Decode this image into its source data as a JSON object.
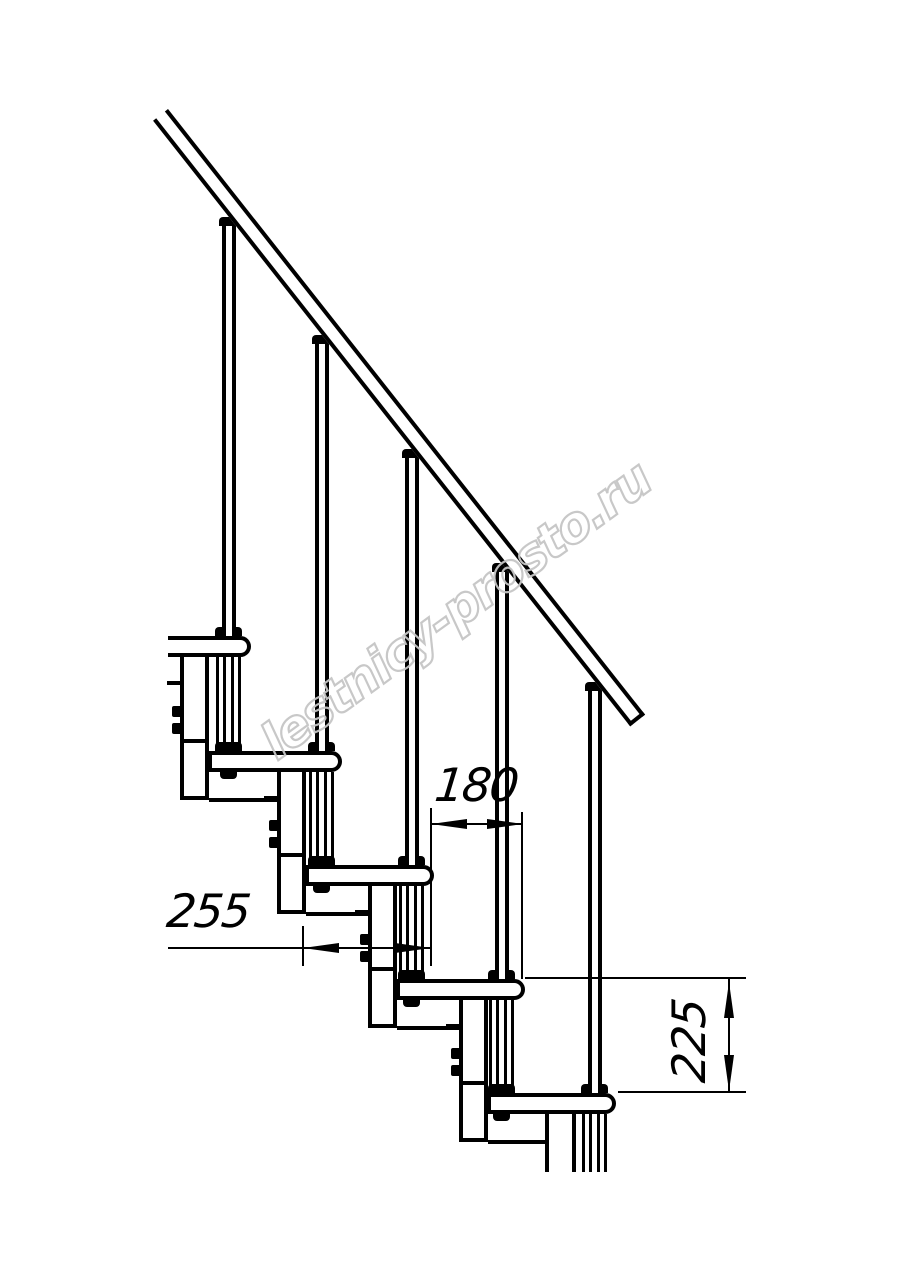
{
  "watermark": {
    "text": "lestnicy-prosto.ru",
    "color": "#c6c6c6"
  },
  "dimensions": {
    "step_run": {
      "label": "180"
    },
    "tread_depth": {
      "label": "255"
    },
    "step_rise": {
      "label": "225"
    }
  },
  "drawing": {
    "type": "technical-drawing",
    "subject": "modular staircase side view: inclined handrail, five balusters, five treads with support columns, dimensioned 180 / 255 / 225",
    "colors": {
      "line": "#000000",
      "background": "#ffffff"
    },
    "treads": {
      "tops": [
        636,
        751,
        865,
        979,
        1093
      ],
      "lefts": [
        168,
        208,
        305,
        396,
        487
      ],
      "rights": [
        251,
        342,
        434,
        525,
        616
      ],
      "height": 21
    },
    "rods": {
      "centers": [
        228.5,
        321.5,
        411.5,
        501.5,
        594.5
      ],
      "collar_tops": [
        217,
        335,
        449,
        563,
        682
      ]
    },
    "columns": {
      "lefts": [
        180,
        277,
        368,
        459,
        545
      ],
      "width": 29
    },
    "rail": {
      "x": 168,
      "y": 109,
      "length": 771,
      "thickness": 19,
      "angle_deg": 51.77
    },
    "cut_bottom_y": 1172
  }
}
